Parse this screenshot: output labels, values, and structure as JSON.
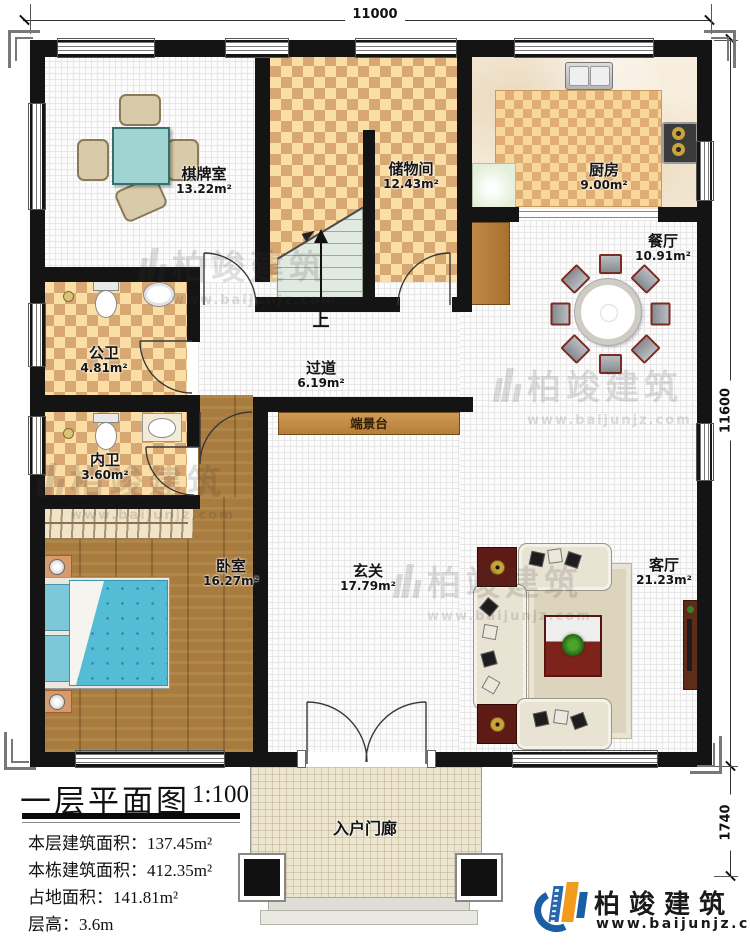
{
  "title_block": {
    "title": "一层平面图",
    "scale": "1:100",
    "stats": [
      "本层建筑面积：137.45m²",
      "本栋建筑面积：412.35m²",
      "占地面积：141.81m²",
      "层高：3.6m"
    ]
  },
  "dimensions": {
    "top": "11000",
    "right_upper": "11600",
    "right_lower": "1740"
  },
  "rooms": {
    "qipaishi": {
      "name": "棋牌室",
      "area": "13.22m²"
    },
    "chuwujian": {
      "name": "储物间",
      "area": "12.43m²"
    },
    "chufang": {
      "name": "厨房",
      "area": "9.00m²"
    },
    "canting": {
      "name": "餐厅",
      "area": "10.91m²"
    },
    "gongwei": {
      "name": "公卫",
      "area": "4.81m²"
    },
    "guodao": {
      "name": "过道",
      "area": "6.19m²"
    },
    "neiwei": {
      "name": "内卫",
      "area": "3.60m²"
    },
    "woshi": {
      "name": "卧室",
      "area": "16.27m²"
    },
    "xuanguan": {
      "name": "玄关",
      "area": "17.79m²"
    },
    "keting": {
      "name": "客厅",
      "area": "21.23m²"
    },
    "duanjingtai": {
      "name": "端景台"
    },
    "rumenlang": {
      "name": "入户门廊"
    }
  },
  "stairs": {
    "up_label": "上"
  },
  "logo": {
    "brand": "柏竣建筑",
    "site": "www.baijunjz.com"
  },
  "watermark": {
    "text": "柏竣建筑",
    "site": "www.baijunjz.com"
  },
  "colors": {
    "wall": "#141414",
    "checker_dark": "#d8a873",
    "checker_light": "#fbdda6",
    "wood": "#a87b3e",
    "bed": "#55bcd6",
    "brand_blue": "#1a5fa6",
    "brand_orange": "#f29b1d"
  }
}
